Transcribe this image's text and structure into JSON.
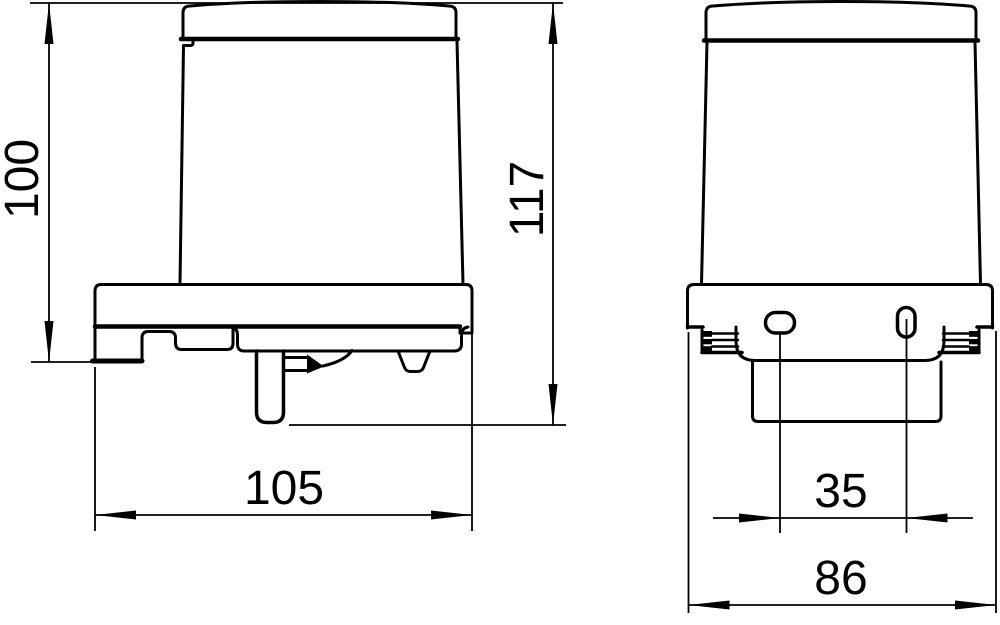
{
  "drawing": {
    "background_color": "#ffffff",
    "line_color": "#000000",
    "views": {
      "front": {
        "dims": {
          "body_height": "100",
          "total_height": "117",
          "width": "105"
        }
      },
      "side": {
        "dims": {
          "hole_spacing": "35",
          "plate_width": "86"
        }
      }
    }
  }
}
